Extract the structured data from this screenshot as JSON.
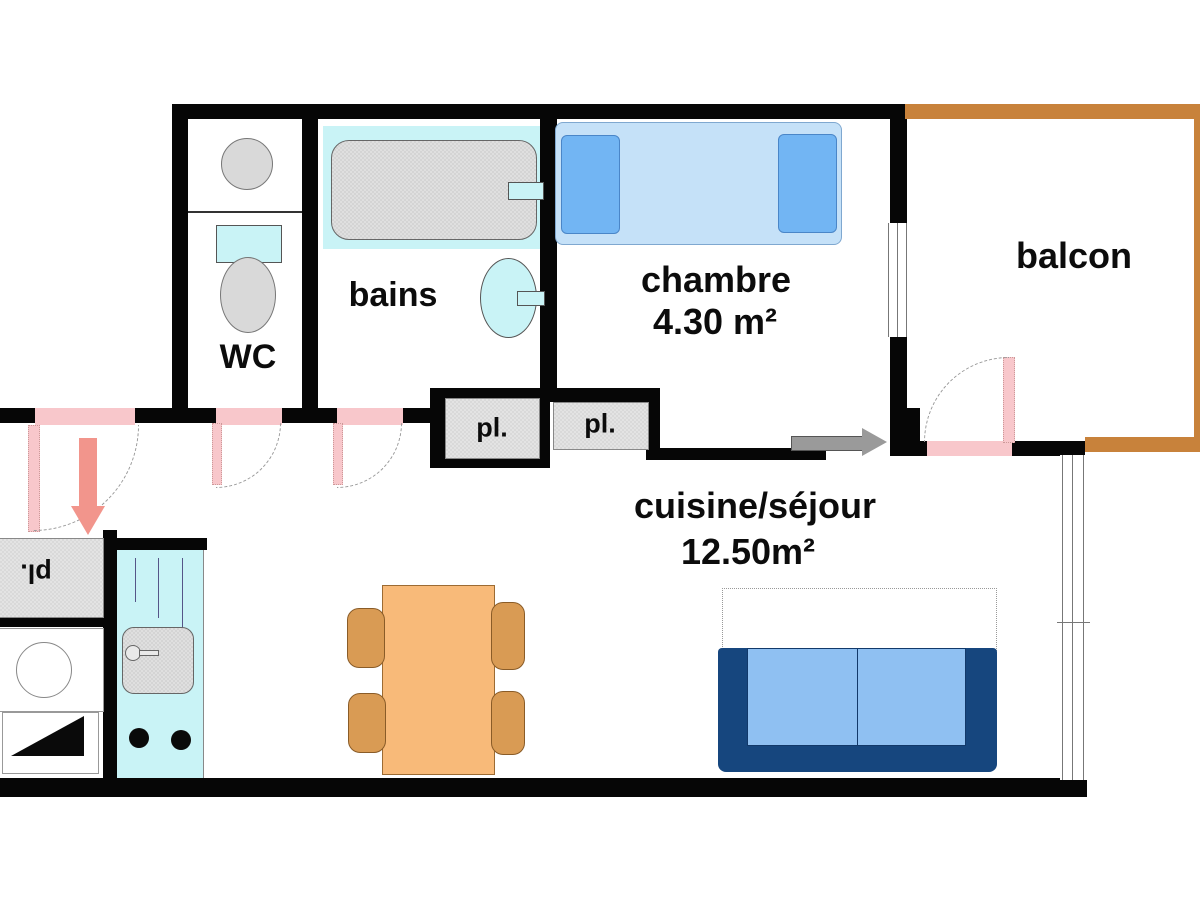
{
  "plan_title": "apartment floor plan",
  "rooms": {
    "wc": {
      "name": "WC"
    },
    "bains": {
      "name": "bains"
    },
    "chambre": {
      "name": "chambre",
      "area": "4.30 m²"
    },
    "balcon": {
      "name": "balcon"
    },
    "cuisine_sejour": {
      "name": "cuisine/séjour",
      "area": "12.50m²"
    },
    "closet_bains": {
      "name": "pl."
    },
    "closet_chambre": {
      "name": "pl."
    },
    "closet_hall": {
      "name": "pl."
    }
  },
  "colors": {
    "wall": "#060606",
    "balcony_wall": "#c8823b",
    "door_pink": "#f8c7cb",
    "fixture_cyan": "#c9f3f6",
    "fixture_gray": "#d9d9d9",
    "bed_fill": "#c5e1f8",
    "pillow_blue": "#72b5f3",
    "sofa_body": "#16467e",
    "sofa_cushion": "#8fc0f2",
    "table_orange": "#f8ba79",
    "chair_orange": "#d99b54",
    "arrow_gray": "#9a9a9a",
    "arrow_pink": "#f2958c"
  }
}
